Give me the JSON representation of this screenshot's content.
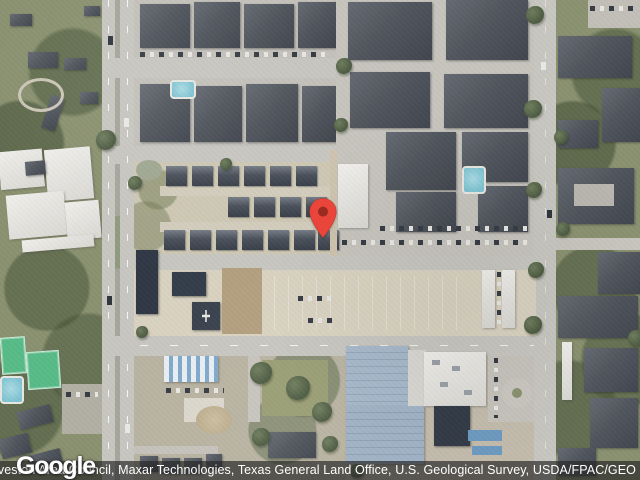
{
  "map": {
    "view_type": "satellite",
    "marker": {
      "present": true,
      "pin_color": "#E9453B",
      "pin_inner_color": "#992B20",
      "tip_x": 323,
      "tip_y": 237
    },
    "features": {
      "west": "wooded area with white industrial buildings, tennis courts and pool",
      "center": "small-home community rows above a tan vacant lot with dark warehouses",
      "northeast": "apartment complexes with dark roofs, pools and carports",
      "south": "blue-roof industrial building, white office building, car lots",
      "roads": "north-south boulevard on left, east-west road mid-bottom, north-south street on right"
    }
  },
  "branding": {
    "logo_text": "Google"
  },
  "attribution": {
    "text": "bus, Houston-Galveston Area Council, Maxar Technologies, Texas General Land Office, U.S. Geological Survey, USDA/FPAC/GEO",
    "text_color": "#ffffff",
    "bar_color": "rgba(38,38,38,0.68)"
  },
  "colors": {
    "road": "#c7c6c0",
    "vegetation": "#8a9170",
    "dark_roof": "#4b515b",
    "navy_roof": "#2f3844",
    "pavement_lot": "#d9d2c1",
    "dirt": "#b3a07f",
    "tennis_green": "#57bb86",
    "pool_blue": "#7fc3d2",
    "blue_roof": "#a0b2c5",
    "white_building": "#e9e8e4"
  }
}
